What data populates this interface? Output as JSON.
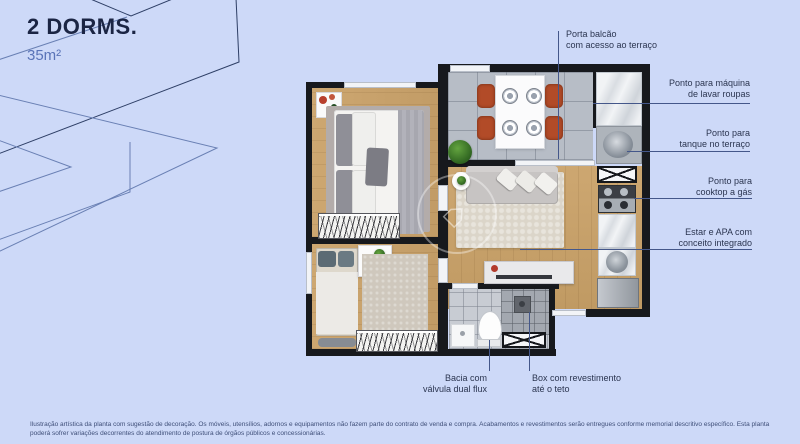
{
  "header": {
    "title": "2 DORMS.",
    "area": "35m²"
  },
  "callouts": {
    "porta_balcao": {
      "line1": "Porta balcão",
      "line2": "com acesso ao terraço"
    },
    "maquina": {
      "line1": "Ponto para máquina",
      "line2": "de lavar roupas"
    },
    "tanque": {
      "line1": "Ponto para",
      "line2": "tanque no terraço"
    },
    "cooktop": {
      "line1": "Ponto para",
      "line2": "cooktop a gás"
    },
    "estar": {
      "line1": "Estar e APA com",
      "line2": "conceito integrado"
    },
    "bacia": {
      "line1": "Bacia com",
      "line2": "válvula dual flux"
    },
    "box": {
      "line1": "Box com revestimento",
      "line2": "até o teto"
    }
  },
  "disclaimer": "Ilustração artística da planta com sugestão de decoração. Os móveis, utensílios, adornos e equipamentos não fazem parte do contrato de venda e compra. Acabamentos e revestimentos serão entregues conforme memorial descritivo específico. Esta planta poderá sofrer variações decorrentes do atendimento de postura de órgãos públicos e concessionárias.",
  "colors": {
    "background": "#cdd9f8",
    "title": "#1b2544",
    "area_label": "#5a74b8",
    "callout_text": "#2b3550",
    "callout_line": "#44578a",
    "wall": "#17191d",
    "wood_floor": "#c8a169",
    "tile_floor": "#b7bdc6",
    "chair_accent": "#b24b28"
  },
  "plan": {
    "furniture_icons": [
      "double-bed",
      "single-bed",
      "wardrobe",
      "nightstand",
      "desk",
      "dining-table",
      "dining-chairs",
      "plates",
      "sofa",
      "throw-pillows",
      "area-rug",
      "side-table",
      "tv-console",
      "plant",
      "washing-machine-spot",
      "laundry-tank",
      "gas-cooktop",
      "kitchen-counter",
      "kitchen-sink",
      "refrigerator",
      "toilet",
      "bathroom-vanity",
      "shower-box",
      "balcony-door",
      "windows",
      "entry-door"
    ]
  }
}
